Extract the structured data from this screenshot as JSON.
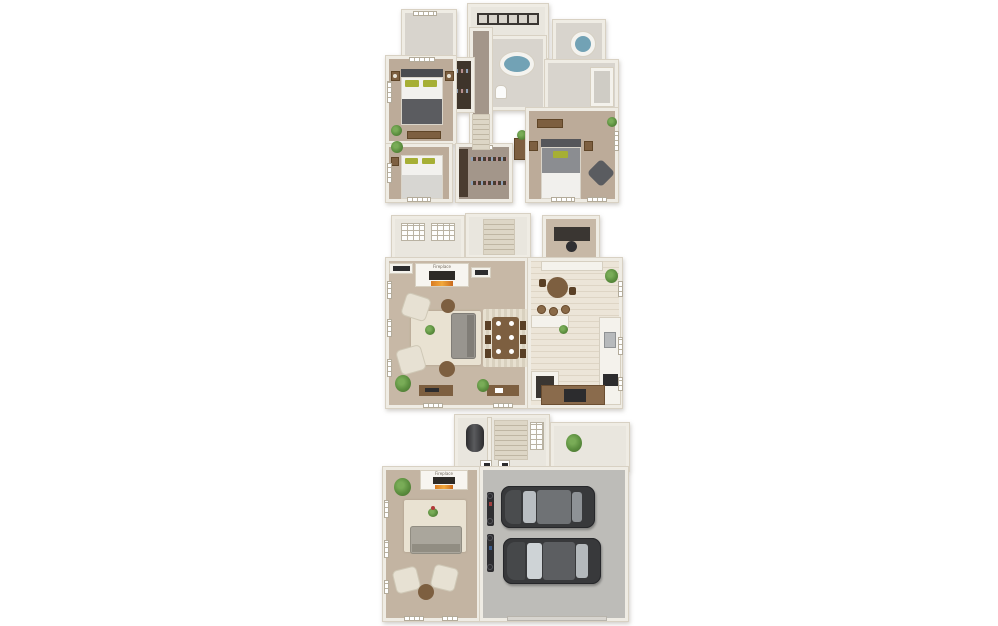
{
  "scene": {
    "type": "3d-floor-plan-stack",
    "background": "#ffffff",
    "floor_count": 3
  },
  "floors": [
    {
      "name": "upper-floor",
      "rooms": [
        "master-bedroom",
        "bedroom-2",
        "bedroom-3",
        "master-bathroom",
        "bathroom-2",
        "bathroom-3",
        "walk-in-closet",
        "hanging-closet",
        "laundry-hall",
        "stair-hall",
        "linen-room"
      ],
      "furniture": [
        "master-bed",
        "bed",
        "bed",
        "nightstands",
        "dresser",
        "oval-soaking-tub",
        "round-tub",
        "toilet",
        "shower",
        "hanging-clothes",
        "accent-chair",
        "bench",
        "plants"
      ]
    },
    {
      "name": "main-floor",
      "fireplace_label": "Fireplace",
      "rooms": [
        "living-room",
        "dining-area",
        "kitchen",
        "breakfast-nook",
        "desk-nook",
        "balcony",
        "stairwell",
        "pantry"
      ],
      "furniture": [
        "fireplace",
        "media-consoles",
        "sofa",
        "armchairs-2",
        "round-side-tables-2",
        "area-rug",
        "dining-table",
        "dining-chairs-6",
        "dining-rug",
        "breakfast-table",
        "bar-stools-3",
        "kitchen-sink",
        "range",
        "counters",
        "console-tables-2",
        "plants"
      ]
    },
    {
      "name": "ground-floor",
      "fireplace_label": "Fireplace",
      "rooms": [
        "family-room",
        "two-car-garage",
        "entry-hall",
        "stairwell",
        "utility-closet",
        "porch"
      ],
      "furniture": [
        "fireplace",
        "sofa",
        "armchairs-2",
        "area-rug",
        "round-side-table",
        "water-heater",
        "wall-art-2",
        "bicycles-2",
        "plants"
      ],
      "vehicles": [
        "sedan",
        "sedan"
      ]
    }
  ],
  "colors": {
    "background": "#ffffff",
    "wall": "#efece4",
    "wall_edge": "#d8d1c3",
    "carpet_bedroom": "#bcab99",
    "carpet_living": "#c7b8a6",
    "hall_carpet": "#a3968a",
    "bath_tile": "#d8d4cd",
    "kitchen_tile": "#ece5d8",
    "garage_floor": "#bdbcb8",
    "rug": "#e9e2d2",
    "tub_water": "#72a2b5",
    "wood": "#7d5f40",
    "sofa_gray": "#98958f",
    "armchair_cream": "#e7e1d3",
    "pillow_green": "#a6af35",
    "car_body": "#38393b",
    "plant_green": "#5c8f3f",
    "fire_orange": "#f2a93c"
  }
}
